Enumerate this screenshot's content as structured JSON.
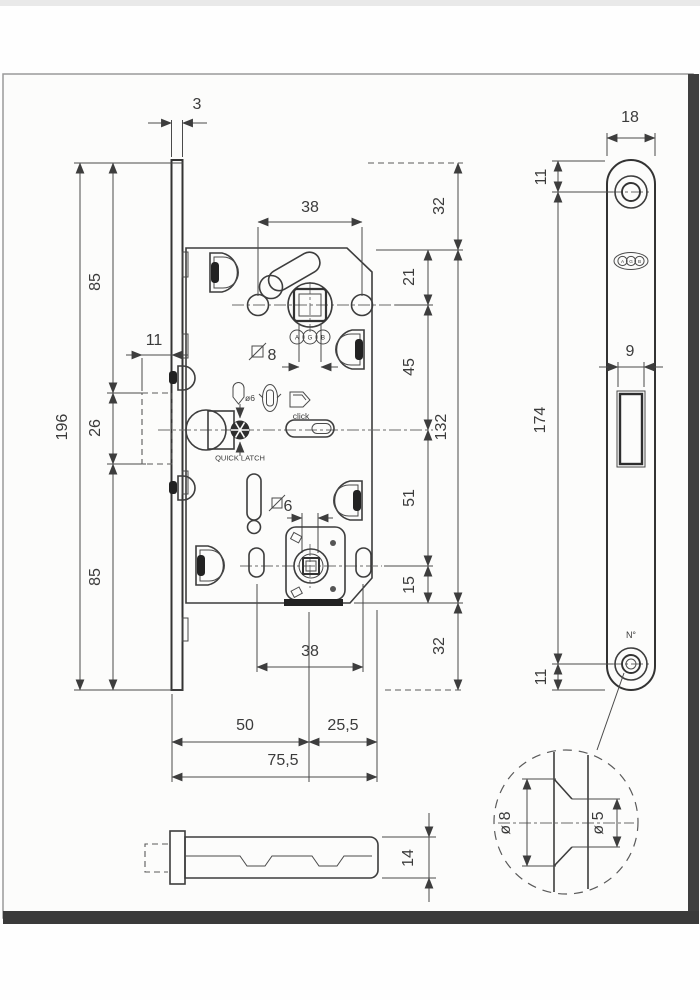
{
  "drawing_title": "magnetic mortise lock technical drawing",
  "ink": "#3d3d3d",
  "paper": "#fcfcfb",
  "brand": [
    "A",
    "G",
    "B"
  ],
  "front": {
    "faceplate_thickness": "3",
    "hole_spacing_top": "38",
    "hole_spacing_bottom": "38",
    "square_follower": "8",
    "square_wc": "6",
    "pin_dia": "ø6",
    "click_label": "click",
    "quick_latch_label": "QUICK LATCH",
    "backset": "50",
    "edge_depth": "25,5",
    "total_depth": "75,5",
    "total_height": "196",
    "height_top": "85",
    "height_mid": "26",
    "height_bottom": "85",
    "magnet_width": "11",
    "right_top": "32",
    "right_21": "21",
    "right_45": "45",
    "body_height": "132",
    "right_51": "51",
    "right_15": "15",
    "right_bottom": "32"
  },
  "side": {
    "plate_width": "18",
    "top_offset": "11",
    "plate_height": "174",
    "latch_width": "9",
    "bottom_offset": "11",
    "hole_note": "N°"
  },
  "strike": {
    "height": "14"
  },
  "detail": {
    "outer_dia": "ø 8",
    "inner_dia": "ø 5"
  }
}
